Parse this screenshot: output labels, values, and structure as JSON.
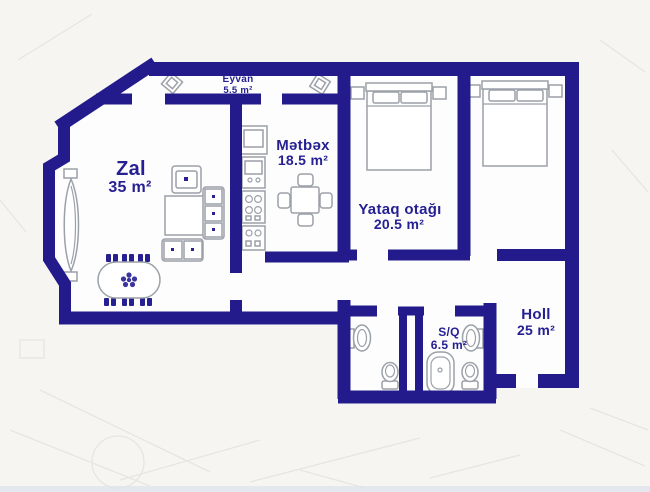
{
  "colors": {
    "wall": "#231b8c",
    "label": "#262093",
    "furniture_outline": "#9ba1a8",
    "background": "#f6f5f2",
    "floor": "#ffffff"
  },
  "rooms": [
    {
      "id": "eyvan",
      "name": "Eyvan",
      "area": "5.5 m²"
    },
    {
      "id": "zal",
      "name": "Zal",
      "area": "35 m²"
    },
    {
      "id": "metbex",
      "name": "Mətbəx",
      "area": "18.5 m²"
    },
    {
      "id": "yataq-otagi",
      "name": "Yataq otağı",
      "area": "20.5 m²"
    },
    {
      "id": "holl",
      "name": "Holl",
      "area": "25 m²"
    },
    {
      "id": "sq",
      "name": "S/Q",
      "area": "6.5 m²"
    }
  ],
  "furniture": {
    "eyvan": [
      "planter",
      "planter"
    ],
    "zal": [
      "curved-bench",
      "armchair",
      "coffee-table",
      "sofa-3-seat",
      "sofa-2-seat",
      "oval-dining-table",
      "dining-chairs-x6"
    ],
    "metbex": [
      "fridge",
      "oven",
      "cooktop",
      "sink-cabinet",
      "table-with-4-chairs"
    ],
    "yataq-otagi": [
      "double-bed",
      "nightstand",
      "nightstand"
    ],
    "bedroom-2": [
      "double-bed",
      "nightstand",
      "nightstand"
    ],
    "wc": [
      "washbasin",
      "toilet"
    ],
    "sq": [
      "bathtub",
      "washbasin",
      "toilet"
    ]
  }
}
